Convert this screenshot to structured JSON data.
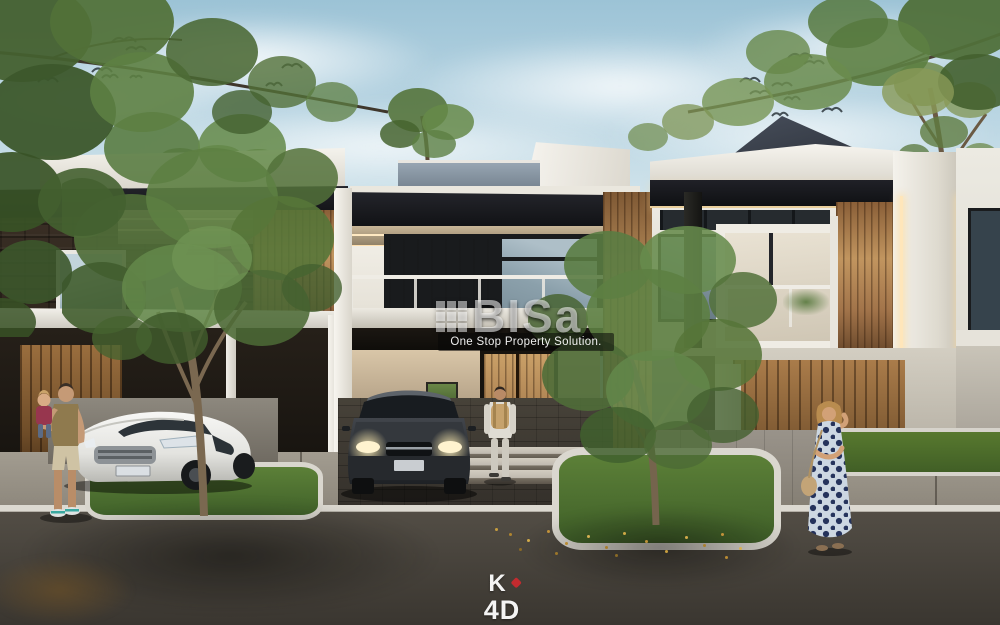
{
  "scene": {
    "subject": "street-view rendering of modern two-storey townhouses with trees, cars and people",
    "palette": {
      "sky": "#bcd8e4",
      "foliage_green": "#5d7f43",
      "wood_slats": "#a97c4e",
      "dark_brick": "#342a21",
      "white_wall": "#efece4",
      "asphalt": "#433f38",
      "grass": "#527434",
      "warm_led": "#ffe4b3"
    },
    "icons": [
      "building-grid-icon",
      "birds-flock-icon",
      "red-dot-icon"
    ]
  },
  "watermark": {
    "icon": "building-grid-icon",
    "title": "BISa",
    "subtitle": "One Stop Property Solution."
  },
  "studio_logo": {
    "top": "K",
    "bottom": "4D",
    "dot_color": "#c32b2f"
  }
}
